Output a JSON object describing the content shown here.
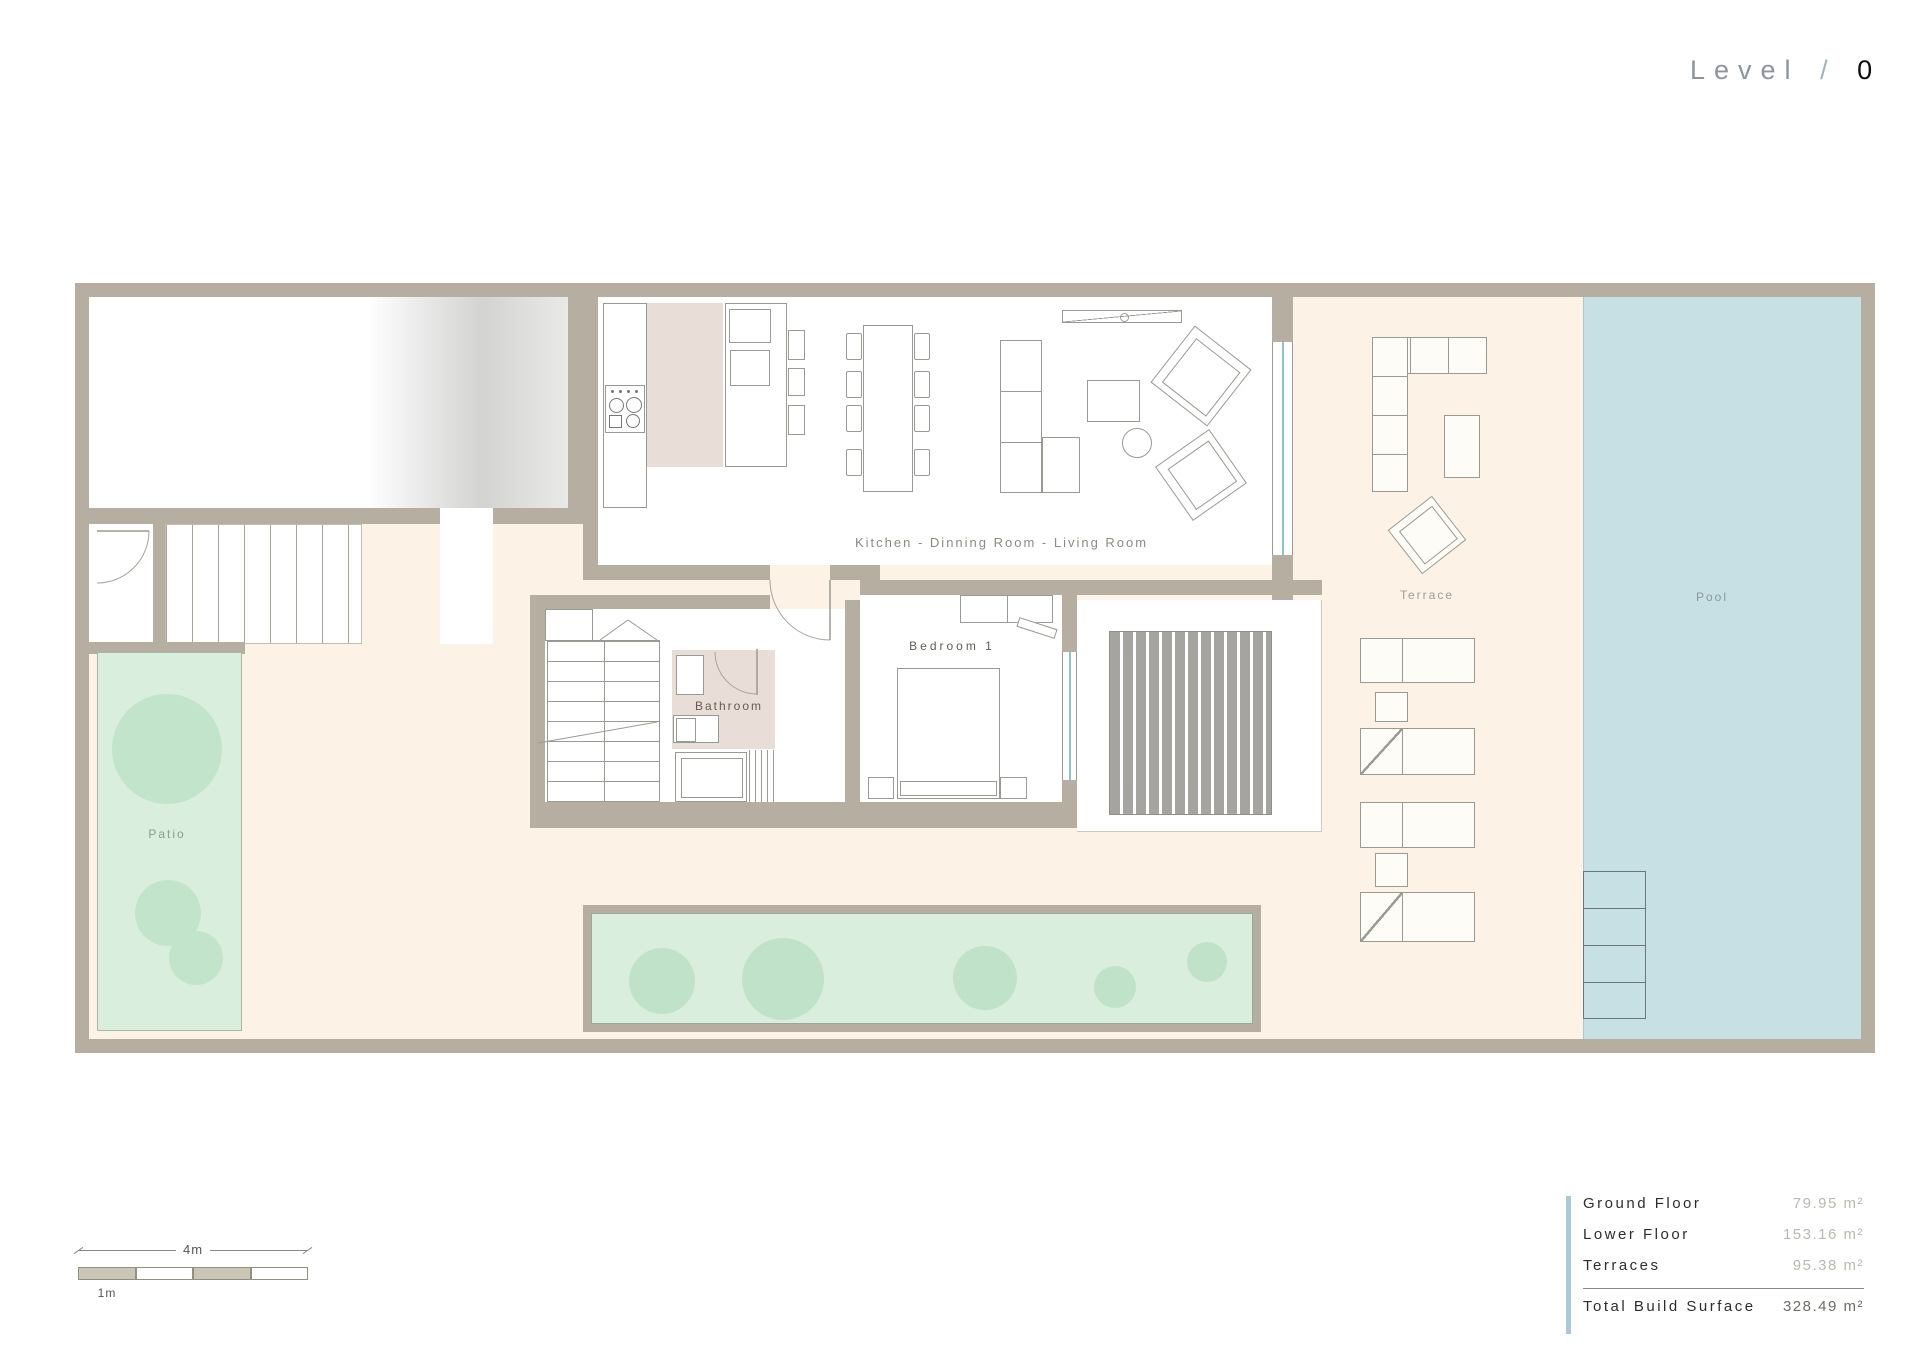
{
  "title": {
    "prefix": "Level",
    "separator": "/",
    "number": "0"
  },
  "plan": {
    "rooms": {
      "kitchen": "Kitchen - Dinning Room - Living Room",
      "bedroom": "Bedroom 1",
      "bathroom": "Bathroom",
      "patio": "Patio",
      "terrace": "Terrace",
      "pool": "Pool"
    }
  },
  "scale_bar": {
    "total": "4m",
    "unit": "1m"
  },
  "area_table": {
    "rows": [
      {
        "label": "Ground Floor",
        "value": "79.95 m²"
      },
      {
        "label": "Lower Floor",
        "value": "153.16 m²"
      },
      {
        "label": "Terraces",
        "value": "95.38 m²"
      }
    ],
    "total": {
      "label": "Total Build Surface",
      "value": "328.49 m²"
    }
  },
  "colors": {
    "wall": "#b6afa1",
    "floor_cream": "#fcf2e6",
    "pool": "#c6e0e3",
    "garden_green": "#d9eedd",
    "tree_green": "#c2e4ca",
    "bath_floor": "#e9ddd7",
    "deck_stripe": "#a5a4a0",
    "accent_blue": "#a9cbd7"
  }
}
